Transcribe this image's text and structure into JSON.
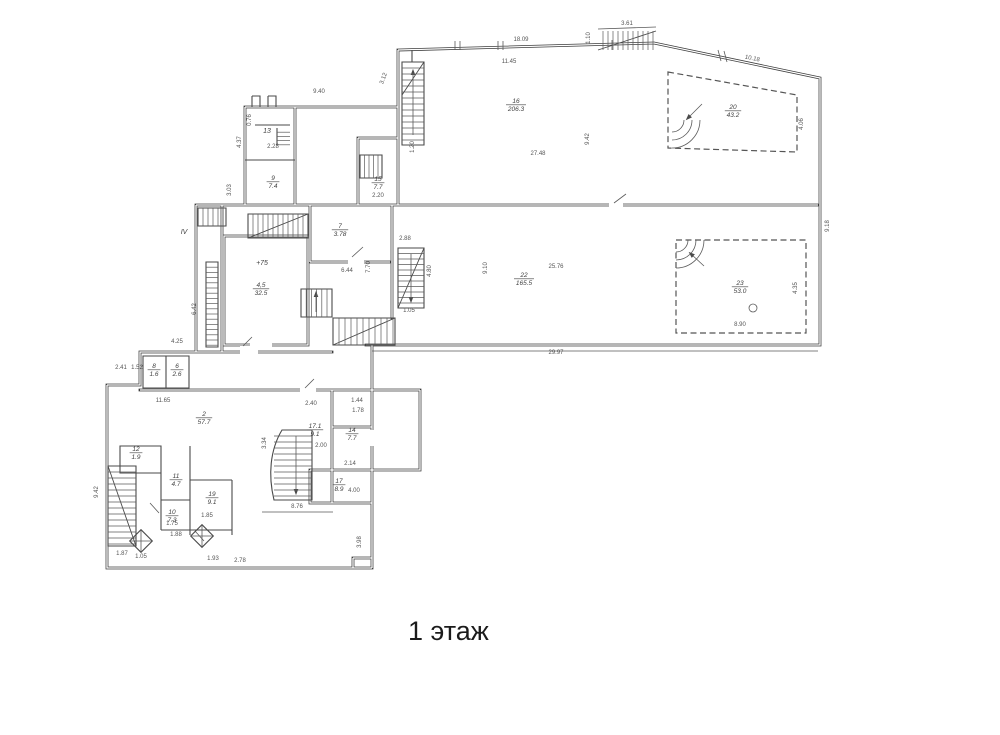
{
  "title": "1 этаж",
  "colors": {
    "wall": "#3d3d3d",
    "thin": "#5a5a5a",
    "label": "#3f3f3f",
    "dim": "#555555",
    "title": "#1b1b1b",
    "bg": "#ffffff"
  },
  "rooms": [
    {
      "num": "16",
      "area": "206.3",
      "x": 516,
      "y": 103
    },
    {
      "num": "20",
      "area": "43.2",
      "x": 733,
      "y": 109
    },
    {
      "num": "22",
      "area": "165.5",
      "x": 524,
      "y": 277
    },
    {
      "num": "23",
      "area": "53.0",
      "x": 740,
      "y": 285
    },
    {
      "num": "7",
      "area": "3.78",
      "x": 340,
      "y": 228
    },
    {
      "num": "4,5",
      "area": "32.5",
      "x": 261,
      "y": 287
    },
    {
      "num": "9",
      "area": "7.4",
      "x": 273,
      "y": 180
    },
    {
      "num": "15",
      "area": "7.7",
      "x": 378,
      "y": 181
    },
    {
      "num": "2",
      "area": "57.7",
      "x": 204,
      "y": 416
    },
    {
      "num": "17.1",
      "area": "9.1",
      "x": 315,
      "y": 428
    },
    {
      "num": "14",
      "area": "7.7",
      "x": 352,
      "y": 432
    },
    {
      "num": "17",
      "area": "8.9",
      "x": 339,
      "y": 483
    },
    {
      "num": "12",
      "area": "1.9",
      "x": 136,
      "y": 451
    },
    {
      "num": "11",
      "area": "4.7",
      "x": 176,
      "y": 478
    },
    {
      "num": "10",
      "area": "7.3",
      "x": 172,
      "y": 514
    },
    {
      "num": "19",
      "area": "9.1",
      "x": 212,
      "y": 496
    },
    {
      "num": "8",
      "area": "1.6",
      "x": 154,
      "y": 368
    },
    {
      "num": "6",
      "area": "2.6",
      "x": 177,
      "y": 368
    }
  ],
  "marks": [
    {
      "t": "IV",
      "x": 184,
      "y": 234
    },
    {
      "t": "13",
      "x": 267,
      "y": 133
    },
    {
      "t": "+75",
      "x": 262,
      "y": 265
    }
  ],
  "dims": [
    {
      "t": "18.09",
      "x": 521,
      "y": 41,
      "r": 0
    },
    {
      "t": "11.45",
      "x": 509,
      "y": 63,
      "r": 0
    },
    {
      "t": "3.61",
      "x": 627,
      "y": 25,
      "r": 0
    },
    {
      "t": "1.10",
      "x": 590,
      "y": 38,
      "r": -90
    },
    {
      "t": "10.18",
      "x": 752,
      "y": 60,
      "r": 12
    },
    {
      "t": "4.06",
      "x": 803,
      "y": 124,
      "r": -90
    },
    {
      "t": "9.42",
      "x": 589,
      "y": 139,
      "r": -90
    },
    {
      "t": "27.48",
      "x": 538,
      "y": 155,
      "r": 0
    },
    {
      "t": "3.12",
      "x": 385,
      "y": 79,
      "r": -70
    },
    {
      "t": "9.40",
      "x": 319,
      "y": 93,
      "r": 0
    },
    {
      "t": "4.37",
      "x": 241,
      "y": 142,
      "r": -90
    },
    {
      "t": "2.28",
      "x": 273,
      "y": 148,
      "r": 0
    },
    {
      "t": "0.76",
      "x": 251,
      "y": 120,
      "r": -90
    },
    {
      "t": "1.20",
      "x": 414,
      "y": 147,
      "r": -90
    },
    {
      "t": "2.20",
      "x": 378,
      "y": 197,
      "r": 0
    },
    {
      "t": "3.03",
      "x": 231,
      "y": 190,
      "r": -90
    },
    {
      "t": "2.88",
      "x": 405,
      "y": 240,
      "r": 0
    },
    {
      "t": "7.70",
      "x": 370,
      "y": 267,
      "r": -90
    },
    {
      "t": "6.44",
      "x": 347,
      "y": 272,
      "r": 0
    },
    {
      "t": "4.80",
      "x": 431,
      "y": 271,
      "r": -90
    },
    {
      "t": "1.05",
      "x": 409,
      "y": 312,
      "r": 0
    },
    {
      "t": "9.10",
      "x": 487,
      "y": 268,
      "r": -90
    },
    {
      "t": "25.76",
      "x": 556,
      "y": 268,
      "r": 0
    },
    {
      "t": "29.97",
      "x": 556,
      "y": 354,
      "r": 0
    },
    {
      "t": "8.90",
      "x": 740,
      "y": 326,
      "r": 0
    },
    {
      "t": "4.35",
      "x": 797,
      "y": 288,
      "r": -90
    },
    {
      "t": "9.18",
      "x": 829,
      "y": 226,
      "r": -90
    },
    {
      "t": "6.42",
      "x": 196,
      "y": 309,
      "r": -90
    },
    {
      "t": "4.25",
      "x": 177,
      "y": 343,
      "r": 0
    },
    {
      "t": "2.41",
      "x": 121,
      "y": 369,
      "r": 0
    },
    {
      "t": "1.52",
      "x": 137,
      "y": 369,
      "r": 0
    },
    {
      "t": "11.65",
      "x": 163,
      "y": 402,
      "r": 0
    },
    {
      "t": "2.40",
      "x": 311,
      "y": 405,
      "r": 0
    },
    {
      "t": "1.44",
      "x": 357,
      "y": 402,
      "r": 0
    },
    {
      "t": "1.78",
      "x": 358,
      "y": 412,
      "r": 0
    },
    {
      "t": "2.00",
      "x": 321,
      "y": 447,
      "r": 0
    },
    {
      "t": "2.14",
      "x": 350,
      "y": 465,
      "r": 0
    },
    {
      "t": "4.00",
      "x": 354,
      "y": 492,
      "r": 0
    },
    {
      "t": "8.76",
      "x": 297,
      "y": 508,
      "r": 0
    },
    {
      "t": "3.34",
      "x": 266,
      "y": 443,
      "r": -90
    },
    {
      "t": "9.42",
      "x": 98,
      "y": 492,
      "r": -90
    },
    {
      "t": "3.98",
      "x": 361,
      "y": 542,
      "r": -90
    },
    {
      "t": "1.75",
      "x": 172,
      "y": 525,
      "r": 0
    },
    {
      "t": "1.85",
      "x": 207,
      "y": 517,
      "r": 0
    },
    {
      "t": "2.78",
      "x": 240,
      "y": 562,
      "r": 0
    },
    {
      "t": "1.93",
      "x": 213,
      "y": 560,
      "r": 0
    },
    {
      "t": "1.87",
      "x": 122,
      "y": 555,
      "r": 0
    },
    {
      "t": "1.05",
      "x": 141,
      "y": 558,
      "r": 0
    },
    {
      "t": "1.88",
      "x": 176,
      "y": 536,
      "r": 0
    }
  ]
}
